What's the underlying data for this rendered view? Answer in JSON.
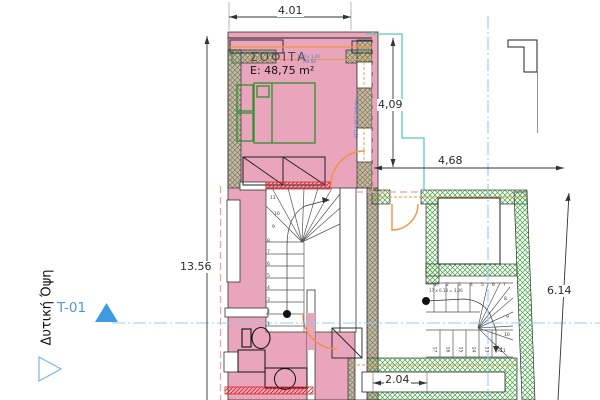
{
  "drawing": {
    "room": {
      "name": "ΣΟΦΙΤΑ",
      "area": "E: 48,75 m²"
    },
    "dimensions": {
      "top": "4.01",
      "upper_right": "4,09",
      "mid_right": "4,68",
      "left": "13.56",
      "far_right": "6.14",
      "bottom": "2.04"
    },
    "section_marker": {
      "tag": "T-01",
      "elevation_name": "Δυτική Όψη"
    },
    "stair_note": "17 x 0,18 = 3,06",
    "window_tags": {
      "top_line1": "1,00 x 1,20",
      "top_line2": "ΠΘ-00",
      "right": "ΠΘ-001  1,00 x 1,20"
    },
    "stairs": {
      "main_numbers": [
        "1",
        "2",
        "3",
        "4",
        "5",
        "6",
        "7",
        "8",
        "9",
        "10",
        "11"
      ],
      "right_top_numbers": [
        "1",
        "2",
        "3",
        "4",
        "5",
        "6",
        "7"
      ],
      "right_side_numbers": [
        "8",
        "9",
        "10",
        "11"
      ],
      "right_bottom_numbers": [
        "17",
        "16",
        "15",
        "14",
        "13",
        "12"
      ]
    },
    "colors": {
      "floor_fill": "#e8a5bb",
      "wall_hatch_green": "#3da23d",
      "insulation_orange": "#f0953f",
      "door_arc_orange": "#f5913e",
      "boundary_dash_pink": "#ef9f9f",
      "section_line_blue": "#8fc9ef",
      "marker_blue": "#3f9be0",
      "roof_outline_teal": "#57cbb8",
      "section_cut_red": "#e02020"
    }
  }
}
